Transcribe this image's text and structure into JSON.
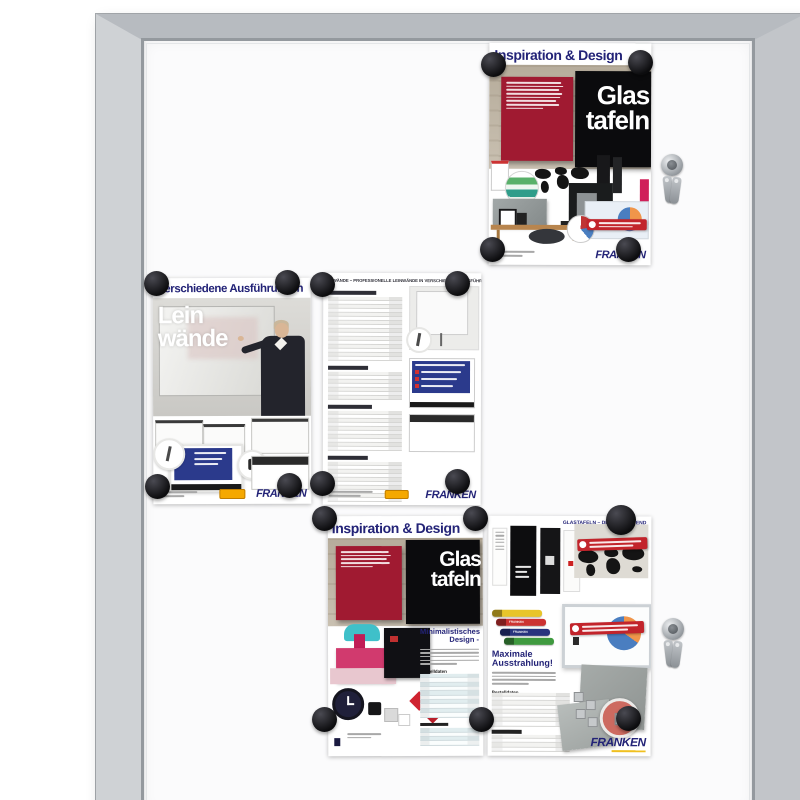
{
  "brand": {
    "name": "FRANKEN",
    "color_navy": "#232377",
    "color_yellow": "#f0c020"
  },
  "board": {
    "frame_color": "#c6c9cd",
    "surface_color": "#fcfcfd",
    "magnet_color": "#141416",
    "magnet_count": 18,
    "lock_count": 2
  },
  "colors": {
    "glassboard_red": "#a01a31",
    "glassboard_pink": "#cf1f5e",
    "banner_red": "#c2242b",
    "badge_orange": "#f5a800",
    "chair_teal": "#3fc0c9",
    "pie_blue": "#4a7ec0",
    "pie_orange": "#f0954a"
  },
  "posters": {
    "glastafeln_top": {
      "title": "Inspiration & Design",
      "headline": [
        "Glas",
        "tafeln"
      ]
    },
    "leinwaende_hero": {
      "title": "Verschiedene Ausführungen",
      "headline": [
        "Lein",
        "wände"
      ]
    },
    "leinwaende_list": {
      "title": "LEINWÄNDE – PROFESSIONELLE LEINWÄNDE IN VERSCHIEDENEN AUSFÜHRUNGEN"
    },
    "glastafeln_bottom": {
      "title": "Inspiration & Design",
      "headline": [
        "Glas",
        "tafeln"
      ],
      "section_heading": "Minimalistisches Design -",
      "table_label": "Bestelldaten"
    },
    "glastafeln_trend": {
      "title": "GLASTAFELN – DESIGN IM TREND",
      "section_heading": "Maximale Ausstrahlung!",
      "table_label": "Bestelldaten"
    }
  }
}
